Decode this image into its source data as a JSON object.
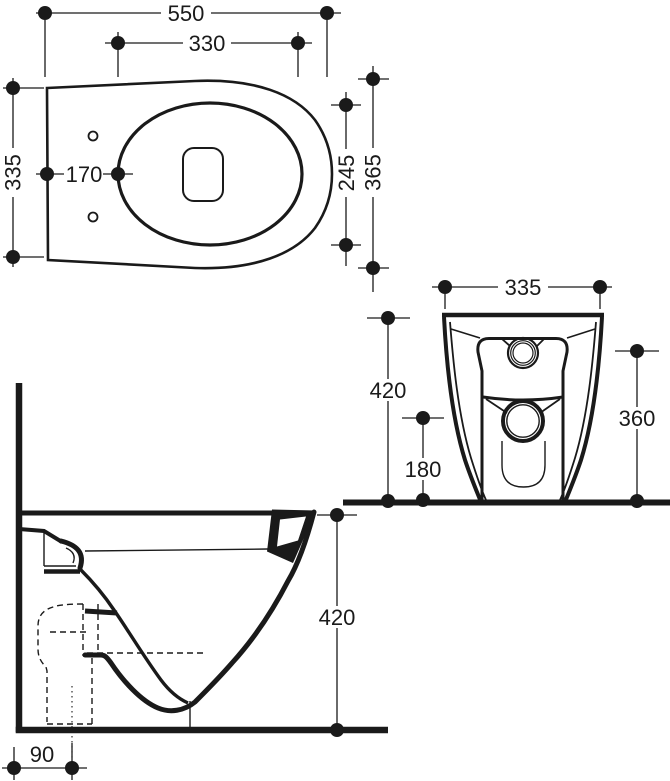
{
  "drawing": {
    "kind": "technical-orthographic-drawing",
    "subject": "back-to-wall toilet pan",
    "line_color": "#1a1a1a",
    "background_color": "#ffffff"
  },
  "dimensions": {
    "plan": {
      "overall_length": "550",
      "fixing_centres": "330",
      "back_width": "335",
      "rear_to_bowl": "170",
      "bowl_inner_width": "245",
      "bowl_outer_width": "365"
    },
    "front": {
      "width": "335",
      "overall_height": "420",
      "trap_centre_height": "180",
      "inlet_centre_height": "360"
    },
    "side": {
      "overall_height": "420",
      "outlet_centre_from_wall": "90"
    }
  }
}
